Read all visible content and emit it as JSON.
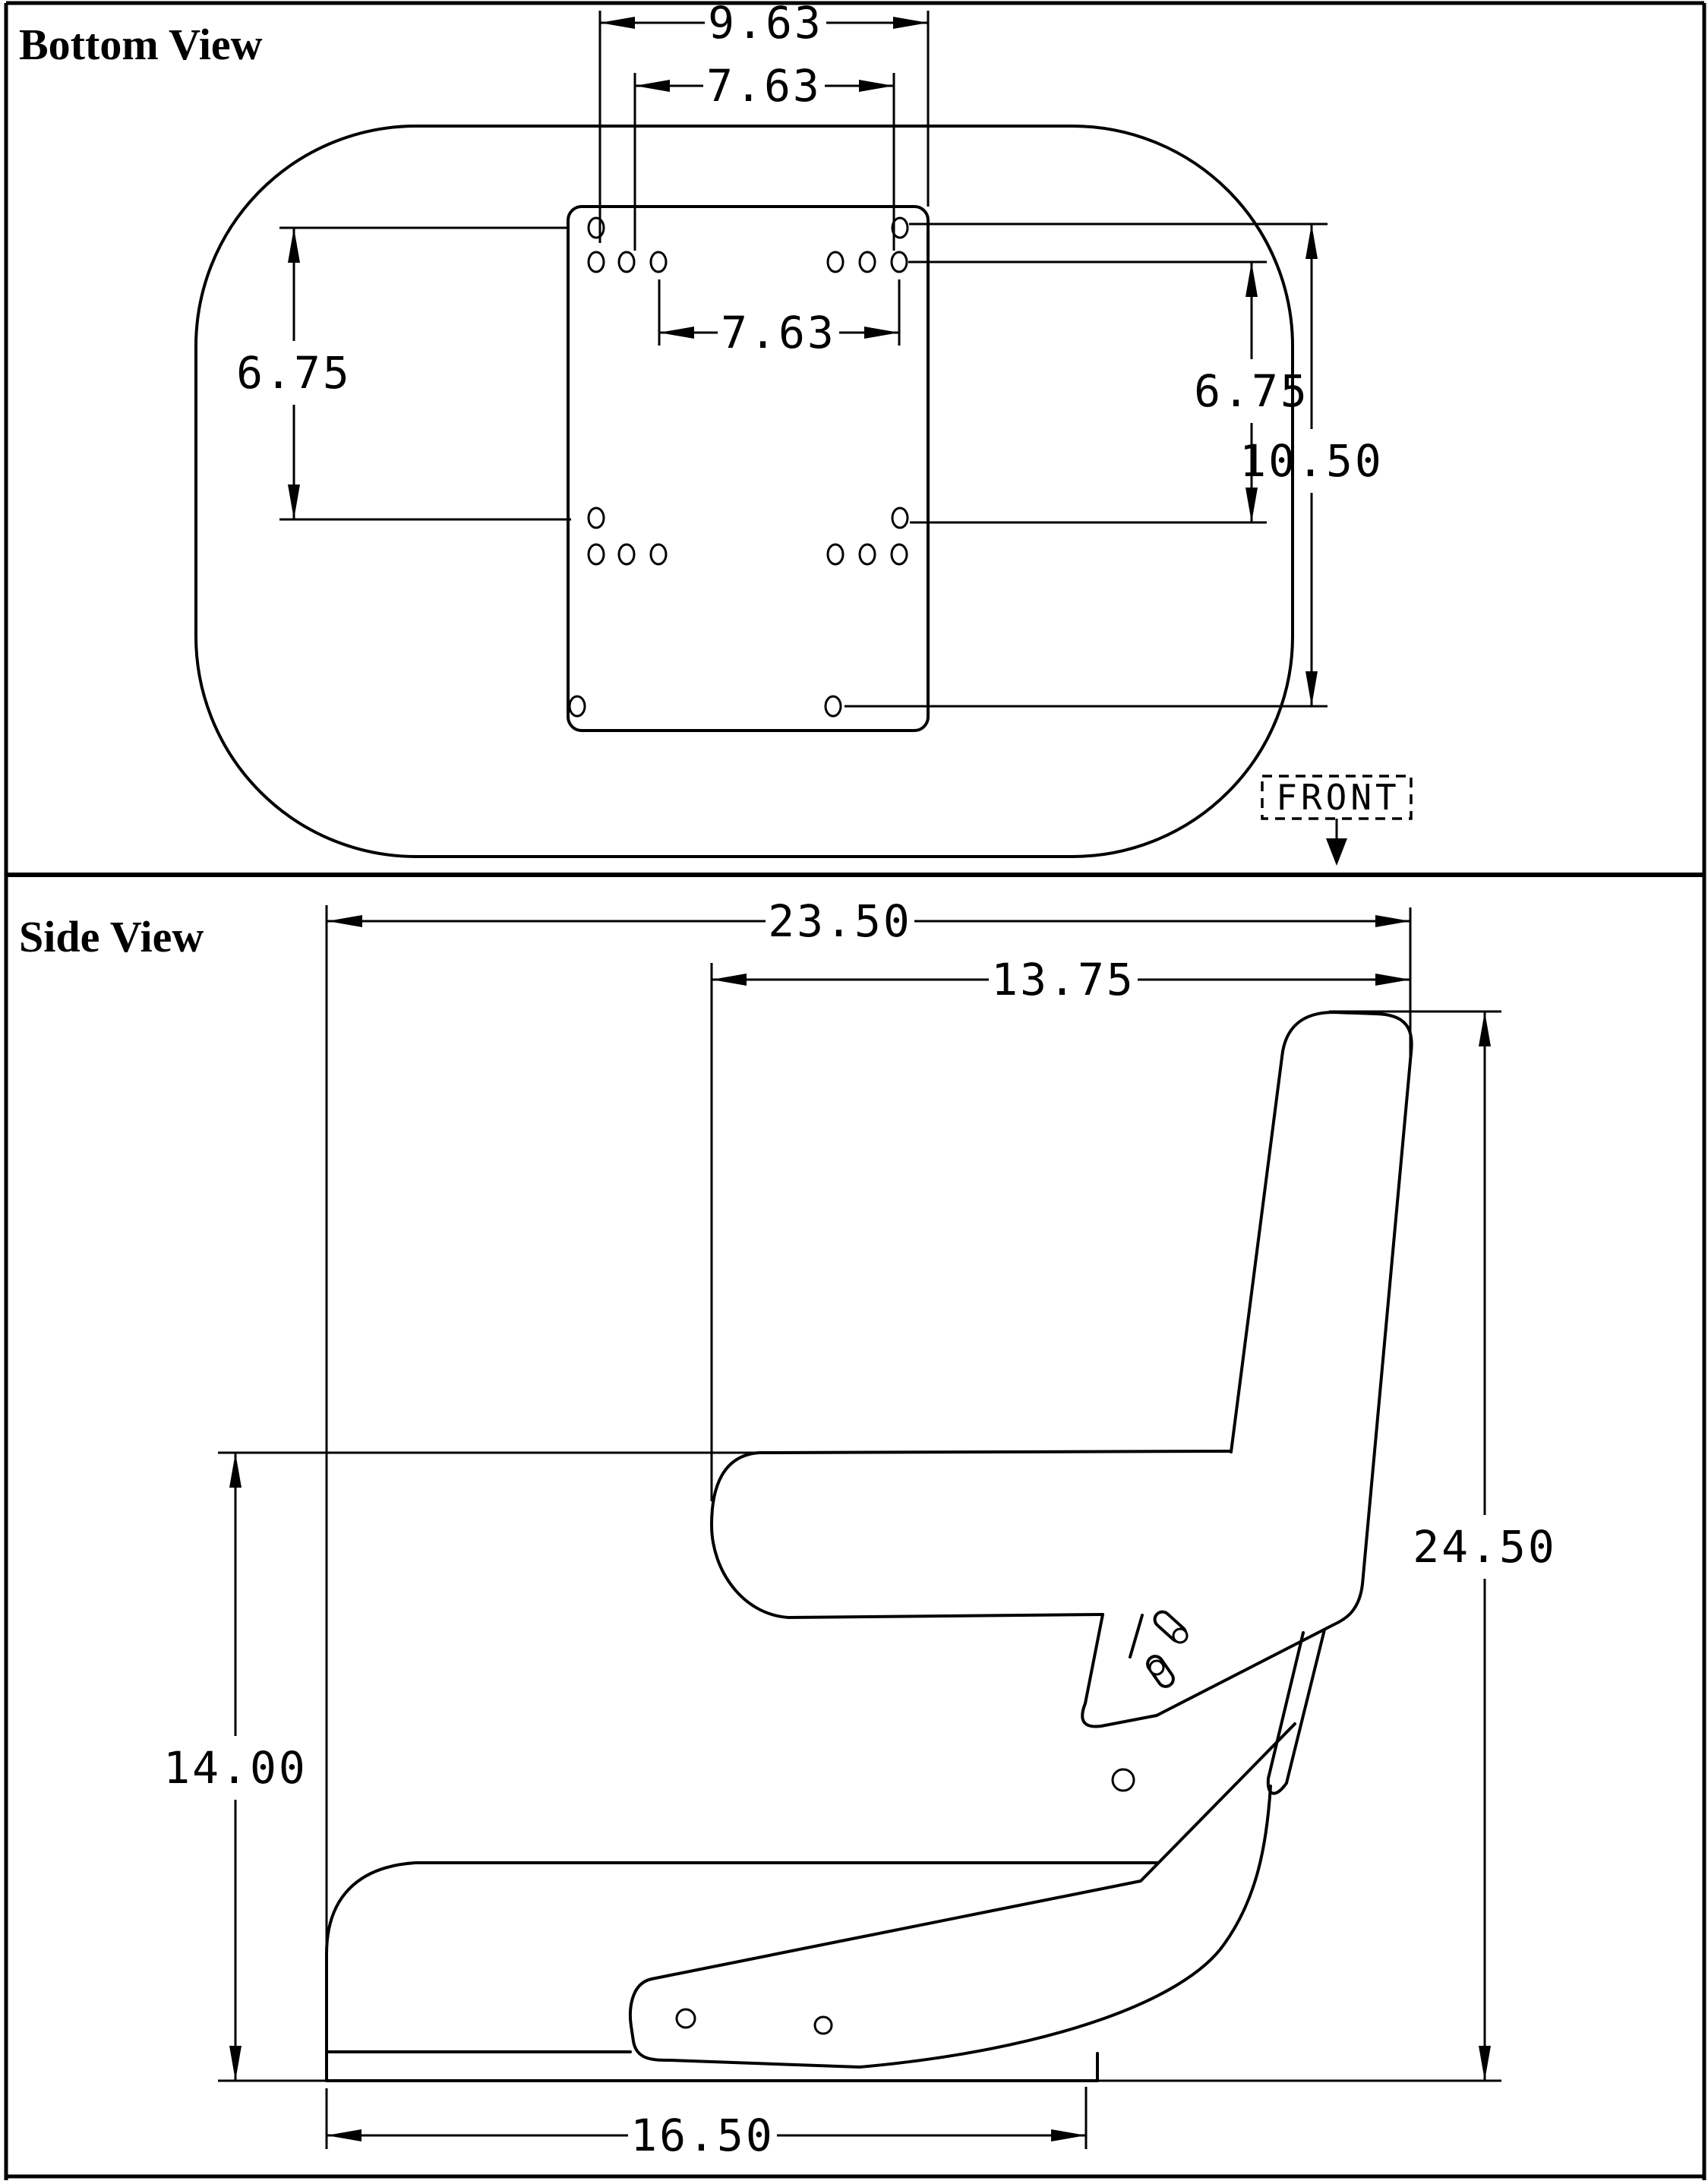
{
  "page": {
    "background": "#ffffff",
    "line_color": "#000000"
  },
  "bottom_view": {
    "title": "Bottom View",
    "front_label": "FRONT",
    "dims": {
      "outer_width": "9.63",
      "inner_width": "7.63",
      "plate_inner_width": "7.63",
      "left_height": "6.75",
      "right_height": "6.75",
      "outer_height": "10.50"
    }
  },
  "side_view": {
    "title": "Side View",
    "dims": {
      "overall_depth": "23.50",
      "back_depth": "13.75",
      "overall_height": "24.50",
      "armrest_height": "14.00",
      "base_depth": "16.50"
    }
  }
}
